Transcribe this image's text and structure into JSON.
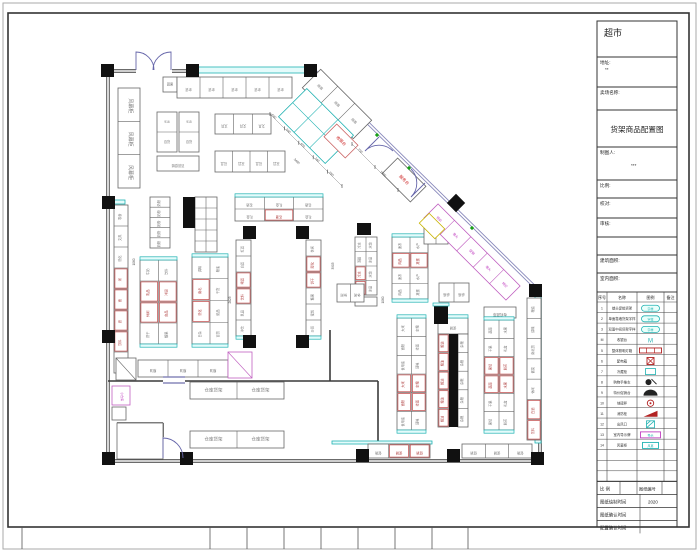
{
  "sheet": {
    "store_name": "超市",
    "drawing_title": "货架商品配置图",
    "bottom_ticks": [
      22,
      210,
      247,
      284,
      321,
      358,
      395,
      432,
      468
    ]
  },
  "title_block": {
    "rows": [
      {
        "y": 21,
        "h": 36,
        "label": "",
        "value": "",
        "big": "store"
      },
      {
        "y": 57,
        "h": 30,
        "label": "地址:",
        "value": "**"
      },
      {
        "y": 87,
        "h": 23,
        "label": "卖场名称:",
        "value": ""
      },
      {
        "y": 110,
        "h": 37,
        "label": "",
        "value": "",
        "big": "title"
      },
      {
        "y": 147,
        "h": 33,
        "label": "制图人:",
        "value": "***"
      },
      {
        "y": 180,
        "h": 18,
        "label": "比例:",
        "value": ""
      },
      {
        "y": 198,
        "h": 20,
        "label": "校对:",
        "value": ""
      },
      {
        "y": 218,
        "h": 19,
        "label": "审核:",
        "value": ""
      },
      {
        "y": 237,
        "h": 18,
        "label": "",
        "value": ""
      },
      {
        "y": 255,
        "h": 18,
        "label": "建筑面积:",
        "value": ""
      },
      {
        "y": 273,
        "h": 19,
        "label": "室内面积:",
        "value": ""
      }
    ],
    "legend": {
      "top": 292,
      "row_h": 10.55,
      "headers": [
        "序号",
        "名称",
        "图例",
        "备注"
      ],
      "rows": [
        {
          "no": "1",
          "name": "端头促销货架",
          "sym": "pill"
        },
        {
          "no": "2",
          "name": "单面靠墙货架字样",
          "sym": "pill"
        },
        {
          "no": "3",
          "name": "双面中间货架字样",
          "sym": "pill"
        },
        {
          "no": "M",
          "name": "收银台",
          "sym": "M"
        },
        {
          "no": "5",
          "name": "整体照明灯箱",
          "sym": "redbar"
        },
        {
          "no": "6",
          "name": "配电箱",
          "sym": "xbox"
        },
        {
          "no": "7",
          "name": "冷藏柜",
          "sym": "cyanbox"
        },
        {
          "no": "8",
          "name": "购物手推车",
          "sym": "cart"
        },
        {
          "no": "9",
          "name": "特价促销台",
          "sym": "dome"
        },
        {
          "no": "10",
          "name": "地磅秤",
          "sym": "ring"
        },
        {
          "no": "11",
          "name": "消防栓",
          "sym": "wedge"
        },
        {
          "no": "12",
          "name": "出风口",
          "sym": "hatch"
        },
        {
          "no": "13",
          "name": "室内导示牌",
          "sym": "magbox"
        },
        {
          "no": "14",
          "name": "风幕柜",
          "sym": "cyanbox2"
        }
      ],
      "empty_rows": 3
    },
    "footer": {
      "scale_label": "比 例",
      "scale_value": "",
      "no_label": "图纸编号",
      "no_value": "",
      "rows": [
        {
          "label": "图纸绘制时间",
          "value": "2020"
        },
        {
          "label": "图纸确认时间",
          "value": ""
        },
        {
          "label": "配置确认时间",
          "value": ""
        }
      ]
    }
  },
  "plan": {
    "walls": [
      {
        "a": [
          108,
          71
        ],
        "b": [
          136,
          71
        ],
        "d": 1
      },
      {
        "a": [
          172,
          71
        ],
        "b": [
          317,
          71
        ],
        "d": 1
      },
      {
        "a": [
          316,
          72
        ],
        "b": [
          540,
          292
        ],
        "d": 1,
        "c": "#8888bb"
      },
      {
        "a": [
          540,
          292
        ],
        "b": [
          540,
          461
        ],
        "d": 1
      },
      {
        "a": [
          540,
          461
        ],
        "b": [
          108,
          461
        ],
        "d": 1
      },
      {
        "a": [
          108,
          461
        ],
        "b": [
          108,
          71
        ],
        "d": 1
      },
      {
        "a": [
          108,
          381
        ],
        "b": [
          163,
          381
        ]
      },
      {
        "a": [
          185,
          381
        ],
        "b": [
          378,
          381
        ]
      },
      {
        "a": [
          330,
          330
        ],
        "b": [
          330,
          381
        ]
      },
      {
        "a": [
          378,
          381
        ],
        "b": [
          378,
          458
        ]
      },
      {
        "a": [
          117,
          423
        ],
        "b": [
          163,
          423
        ]
      },
      {
        "a": [
          163,
          423
        ],
        "b": [
          163,
          437
        ]
      }
    ],
    "bands": [
      [
        197,
        67,
        108,
        6
      ],
      [
        535,
        296,
        6,
        147
      ],
      [
        332,
        441,
        100,
        3
      ],
      [
        113,
        200,
        12,
        4
      ]
    ],
    "bars": [
      [
        183,
        197,
        12,
        31
      ],
      [
        357,
        223,
        14,
        12
      ],
      [
        449,
        334,
        9,
        93
      ]
    ],
    "columns": [
      [
        101,
        64
      ],
      [
        186,
        64
      ],
      [
        304,
        64
      ],
      [
        102,
        196
      ],
      [
        102,
        330
      ],
      [
        102,
        452
      ],
      [
        180,
        452
      ],
      [
        356,
        449
      ],
      [
        447,
        449
      ],
      [
        531,
        452
      ],
      [
        243,
        226
      ],
      [
        296,
        226
      ],
      [
        243,
        335
      ],
      [
        296,
        335
      ],
      [
        529,
        284
      ]
    ],
    "capped_columns": [
      {
        "x": 434,
        "y": 306,
        "w": 14,
        "h": 18
      }
    ],
    "diamond_columns": [
      {
        "cx": 456,
        "cy": 203,
        "s": 13
      }
    ],
    "doors": [
      "M136,70 L136,52 A18,18 0 0 1 154,70",
      "M171,70 L171,52 A18,18 0 0 0 153,70",
      "M379,137 L365,151 A19.8,19.8 0 0 1 393,151",
      "M425,183 L411,197 A19.8,19.8 0 0 0 411,169",
      "M163,458 L163,438 A20,20 0 0 1 183,458"
    ],
    "door_marks": [
      [
        163,
        377,
        22,
        6
      ]
    ],
    "greens": [
      [
        377,
        135
      ],
      [
        409,
        168
      ],
      [
        472,
        228
      ]
    ],
    "shelves": [
      {
        "x": 163,
        "y": 77,
        "w": 14,
        "h": 15,
        "lb": [
          "蔬果"
        ],
        "lr": 0
      },
      {
        "x": 177,
        "y": 77,
        "w": 115,
        "h": 21,
        "cols": 5,
        "lb": [
          "杂货"
        ],
        "lr": 180
      },
      {
        "x": 157,
        "y": 112,
        "w": 20,
        "h": 40,
        "rows": 2,
        "lb": [
          "916",
          "百货"
        ],
        "lr": 0
      },
      {
        "x": 179,
        "y": 112,
        "w": 20,
        "h": 40,
        "rows": 2,
        "lb": [
          "915",
          "百货"
        ],
        "lr": 0
      },
      {
        "x": 157,
        "y": 156,
        "w": 42,
        "h": 15,
        "lb": [
          "百货促销"
        ],
        "lr": 180
      },
      {
        "x": 215,
        "y": 114,
        "w": 56,
        "h": 20,
        "cols": 3,
        "lb": [
          "文具"
        ],
        "lr": 180
      },
      {
        "x": 215,
        "y": 151,
        "w": 70,
        "h": 21,
        "cols": 4,
        "lb": [
          "玩具"
        ],
        "lr": 180
      },
      {
        "x": 118,
        "y": 88,
        "w": 22,
        "h": 100,
        "rows": 3,
        "lb": [
          "风幕柜"
        ],
        "lr": 90,
        "fs": 5
      },
      {
        "x": 114,
        "y": 205,
        "w": 14,
        "h": 168,
        "rows": 8,
        "red": [
          3,
          4,
          5,
          6
        ],
        "lb": [
          "零食",
          "文具",
          "洗化",
          "米",
          "面",
          "酒",
          "饮料",
          "日配"
        ],
        "lr": -90
      },
      {
        "x": 116,
        "y": 358,
        "w": 20,
        "h": 22,
        "diag": 1
      },
      {
        "x": 138,
        "y": 360,
        "w": 90,
        "h": 17,
        "cols": 3,
        "lb": [
          "粮油"
        ],
        "lr": 180
      },
      {
        "x": 228,
        "y": 352,
        "w": 24,
        "h": 26,
        "diag": 1,
        "stroke": "#c060c0"
      },
      {
        "x": 112,
        "y": 386,
        "w": 18,
        "h": 19,
        "stroke": "#c060c0",
        "lb": [
          "小仓库"
        ],
        "lc": "#c040c0",
        "lr": 90,
        "fs": 3
      },
      {
        "x": 112,
        "y": 407,
        "w": 14,
        "h": 13
      },
      {
        "x": 150,
        "y": 197,
        "w": 20,
        "h": 51,
        "rows": 5,
        "lb": [
          "奶粉"
        ],
        "lr": -90
      },
      {
        "x": 195,
        "y": 197,
        "w": 22,
        "h": 55,
        "rows": 5,
        "cols": 2
      },
      {
        "x": 140,
        "y": 260,
        "w": 37,
        "h": 84,
        "cols": 2,
        "rows": 4,
        "capT": 1,
        "capB": 1,
        "red": [
          2,
          3,
          4,
          5
        ],
        "lb": [
          "牛奶",
          "饮料",
          "乳品",
          "冲调",
          "休闲",
          "食品",
          "饼干",
          "糖果"
        ],
        "lr": -90
      },
      {
        "x": 192,
        "y": 257,
        "w": 36,
        "h": 87,
        "cols": 2,
        "rows": 4,
        "capT": 1,
        "capB": 1,
        "red": [
          2,
          4
        ],
        "lb": [
          "调味",
          "粮油",
          "南北",
          "干货",
          "洗化",
          "纸品",
          "日杂",
          "百货"
        ],
        "lr": -90
      },
      {
        "x": 235,
        "y": 197,
        "w": 88,
        "h": 24,
        "cols": 3,
        "rows": 2,
        "capT": 1,
        "red": [
          4
        ],
        "lb": [
          "名酒",
          "礼盒"
        ],
        "lr": 180
      },
      {
        "x": 236,
        "y": 240,
        "w": 15,
        "h": 96,
        "rows": 6,
        "capB": 1,
        "red": [
          2,
          3
        ],
        "lb": [
          "红酒",
          "白酒",
          "啤酒",
          "饮料",
          "乳品",
          "冲饮"
        ],
        "lr": -90
      },
      {
        "x": 306,
        "y": 240,
        "w": 15,
        "h": 96,
        "rows": 6,
        "capB": 1,
        "red": [
          1,
          2
        ],
        "lb": [
          "休闲",
          "膨化",
          "饼干",
          "糖果",
          "蜜饯",
          "炒货"
        ],
        "lr": -90
      },
      {
        "x": 355,
        "y": 237,
        "w": 22,
        "h": 58,
        "rows": 4,
        "cols": 2,
        "red": [
          4,
          6
        ],
        "lb": [
          "冷冻",
          "水饺",
          "汤圆",
          "冰品"
        ],
        "lr": -90
      },
      {
        "x": 355,
        "y": 297,
        "w": 22,
        "h": 9
      },
      {
        "x": 392,
        "y": 237,
        "w": 36,
        "h": 62,
        "cols": 2,
        "rows": 4,
        "capT": 1,
        "capB": 1,
        "red": [
          2,
          3
        ],
        "lb": [
          "速冻",
          "水产",
          "肉品",
          "禽蛋"
        ],
        "lr": -90
      },
      {
        "x": 424,
        "y": 228,
        "w": 24,
        "h": 16,
        "cols": 2
      },
      {
        "x": 337,
        "y": 284,
        "w": 27,
        "h": 18,
        "cols": 2,
        "lb": [
          "休闲"
        ],
        "lr": 180
      },
      {
        "x": 439,
        "y": 283,
        "w": 30,
        "h": 19,
        "cols": 2,
        "lb": [
          "桌椅"
        ],
        "lr": 180
      },
      {
        "x": 484,
        "y": 307,
        "w": 32,
        "h": 11,
        "lb": [
          "有机蔬菜"
        ],
        "lr": 180,
        "fs": 3.5
      },
      {
        "x": 484,
        "y": 320,
        "w": 30,
        "h": 110,
        "cols": 2,
        "rows": 6,
        "capT": 1,
        "capB": 1,
        "red": [
          4,
          5,
          6,
          7
        ],
        "lb": [
          "蔬菜",
          "水果",
          "干果",
          "礼盒",
          "果切",
          "鲜花"
        ],
        "lr": -90
      },
      {
        "x": 397,
        "y": 318,
        "w": 29,
        "h": 112,
        "cols": 2,
        "rows": 6,
        "capT": 1,
        "capB": 1,
        "red": [
          6,
          7,
          8,
          9
        ],
        "lb": [
          "大米",
          "杂粮",
          "面粉",
          "挂面",
          "食用油",
          "调味"
        ],
        "lr": -90
      },
      {
        "x": 438,
        "y": 318,
        "w": 30,
        "h": 16,
        "capT": 1,
        "lb": [
          "促销"
        ],
        "lr": 180
      },
      {
        "x": 438,
        "y": 334,
        "w": 11,
        "h": 93,
        "rows": 5,
        "red": [
          0,
          1,
          2,
          3,
          4
        ],
        "lb": [
          "粮油"
        ],
        "lr": -90
      },
      {
        "x": 458,
        "y": 334,
        "w": 10,
        "h": 93,
        "rows": 5,
        "lb": [
          "杂粮"
        ],
        "lr": -90
      },
      {
        "x": 527,
        "y": 298,
        "w": 14,
        "h": 142,
        "rows": 7,
        "red": [
          5,
          6
        ],
        "lb": [
          "粮油",
          "调味",
          "南北货",
          "酱菜",
          "休闲",
          "白酒",
          "饮料"
        ],
        "lr": -90
      },
      {
        "x": 368,
        "y": 444,
        "w": 62,
        "h": 14,
        "cols": 3,
        "red": [
          1,
          2
        ],
        "lb": [
          "促销"
        ],
        "lr": 180
      },
      {
        "x": 462,
        "y": 444,
        "w": 70,
        "h": 14,
        "cols": 3,
        "lb": [
          "促销"
        ],
        "lr": 180
      },
      {
        "x": 190,
        "y": 382,
        "w": 94,
        "h": 17,
        "cols": 2,
        "lb": [
          "仓库货架",
          "仓库货架"
        ],
        "lr": 0,
        "fs": 4.5
      },
      {
        "x": 190,
        "y": 431,
        "w": 94,
        "h": 17,
        "cols": 2,
        "lb": [
          "仓库货架",
          "仓库货架"
        ],
        "lr": 0,
        "fs": 4.5
      },
      {
        "x": 117,
        "y": 423,
        "w": 46,
        "h": 36
      }
    ],
    "rot_shelves": [
      {
        "cx": 337,
        "cy": 104,
        "w": 72,
        "h": 26,
        "cols": 3,
        "rot": 45,
        "lb": [
          "烟酒"
        ],
        "lr": 0
      },
      {
        "cx": 316,
        "cy": 126,
        "w": 66,
        "h": 40,
        "cols": 3,
        "rows": 2,
        "rot": 45,
        "stroke": "#20b2b2"
      },
      {
        "cx": 341,
        "cy": 141,
        "w": 30,
        "h": 18,
        "rot": 45,
        "stroke": "#cc6666",
        "lb": [
          "收银台"
        ],
        "lc": "#cc2222",
        "fs": 4
      },
      {
        "cx": 404,
        "cy": 180,
        "w": 40,
        "h": 22,
        "rot": 45,
        "lb": [
          "服务台"
        ],
        "lc": "#cc2222",
        "fs": 4
      },
      {
        "cx": 472,
        "cy": 252,
        "w": 116,
        "h": 20,
        "cols": 5,
        "rot": 45,
        "stroke": "#c060c0",
        "lb": [
          "特价",
          "堆头",
          "促销",
          "堆头",
          "特价"
        ],
        "lc": "#c040c0"
      },
      {
        "cx": 432,
        "cy": 226,
        "w": 22,
        "h": 14,
        "rot": 45,
        "stroke": "#c8b400"
      }
    ],
    "dims": [
      {
        "x1": 270,
        "y1": 114,
        "x2": 342,
        "y2": 186,
        "labels": [
          "640",
          "640",
          "650",
          "740",
          "650"
        ]
      },
      {
        "x1": 352,
        "y1": 144,
        "x2": 398,
        "y2": 190,
        "labels": [
          "730",
          "1060"
        ]
      }
    ],
    "texts": [
      {
        "t": "3480",
        "x": 296,
        "y": 162,
        "r": 45
      },
      {
        "t": "1060",
        "x": 135,
        "y": 262,
        "r": -90
      },
      {
        "t": "2625",
        "x": 231,
        "y": 300,
        "r": -90
      },
      {
        "t": "3905",
        "x": 334,
        "y": 266,
        "r": -90
      },
      {
        "t": "1060",
        "x": 384,
        "y": 300,
        "r": -90
      }
    ]
  }
}
